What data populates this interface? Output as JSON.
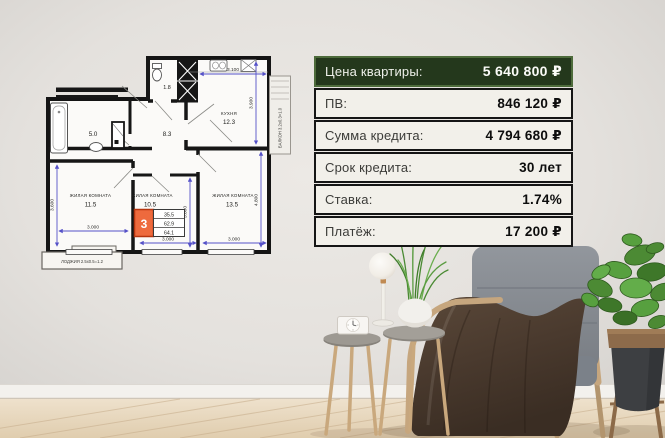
{
  "poster": {
    "price_table": {
      "header": {
        "label": "Цена квартиры:",
        "value": "5 640 800 ₽"
      },
      "rows": [
        {
          "label": "ПВ:",
          "value": "846 120 ₽"
        },
        {
          "label": "Сумма кредита:",
          "value": "4 794 680 ₽"
        },
        {
          "label": "Срок кредита:",
          "value": "30 лет"
        },
        {
          "label": "Ставка:",
          "value": "1.74%"
        },
        {
          "label": "Платёж:",
          "value": "17 200 ₽"
        }
      ],
      "colors": {
        "header_bg": "#24381c",
        "header_border": "#4d6b3b",
        "row_bg": "#f2f0ea",
        "row_border": "#151515",
        "label_color": "#3c3c39",
        "value_color": "#0d0d0d"
      }
    },
    "floor_plan": {
      "rooms": {
        "wc_area": "1.8",
        "kitchen_label": "КУХНЯ",
        "kitchen_area": "12.3",
        "bathroom_area": "5.0",
        "hall_area": "8.3",
        "living1_label": "ЖИЛАЯ КОМНАТА",
        "living1_area": "11.5",
        "living2_label": "ЖИЛАЯ КОМНАТА",
        "living2_area": "10.5",
        "living3_label": "ЖИЛАЯ КОМНАТА",
        "living3_area": "13.5"
      },
      "balcony_label": "БАЛКОН 3.2х0.3=1.0",
      "loggia_label": "ЛОДЖИЯ 2.5х0.5=1.2",
      "stamp": {
        "rooms_count": "3",
        "living_area": "35.5",
        "area_without_balcony": "62.9",
        "total_area": "64.1"
      },
      "dims": {
        "kitchen_w": "3.100",
        "kitchen_h": "3.900",
        "living1_h": "3.600",
        "living1_w": "3.000",
        "living2_h": "3.600",
        "living2_w": "3.000",
        "living3_h": "4.800",
        "living3_w": "3.000"
      },
      "colors": {
        "dimension": "#5551c8",
        "stamp_fill": "#ee6a3d",
        "wall": "#161616"
      }
    }
  },
  "scene": {
    "colors": {
      "wall": "#e4e1dd",
      "floor_wood": "#e8d9c1",
      "baseboard": "#f3f1ed",
      "chair_wood": "#c6a67e",
      "chair_fabric": "#868b92",
      "blanket": "#4d3d31",
      "plant_green": "#57a03f",
      "plant_pot": "#3d3f42",
      "pot_rim": "#8d6b4b",
      "lamp": "#f4f2ee",
      "table_top": "#9b9792"
    },
    "objects": [
      "wall",
      "baseboard",
      "wood-floor",
      "armchair",
      "blanket",
      "potted-plant",
      "plant-stand",
      "side-table-large",
      "side-table-small",
      "table-lamp",
      "grass-plant",
      "clock"
    ]
  }
}
